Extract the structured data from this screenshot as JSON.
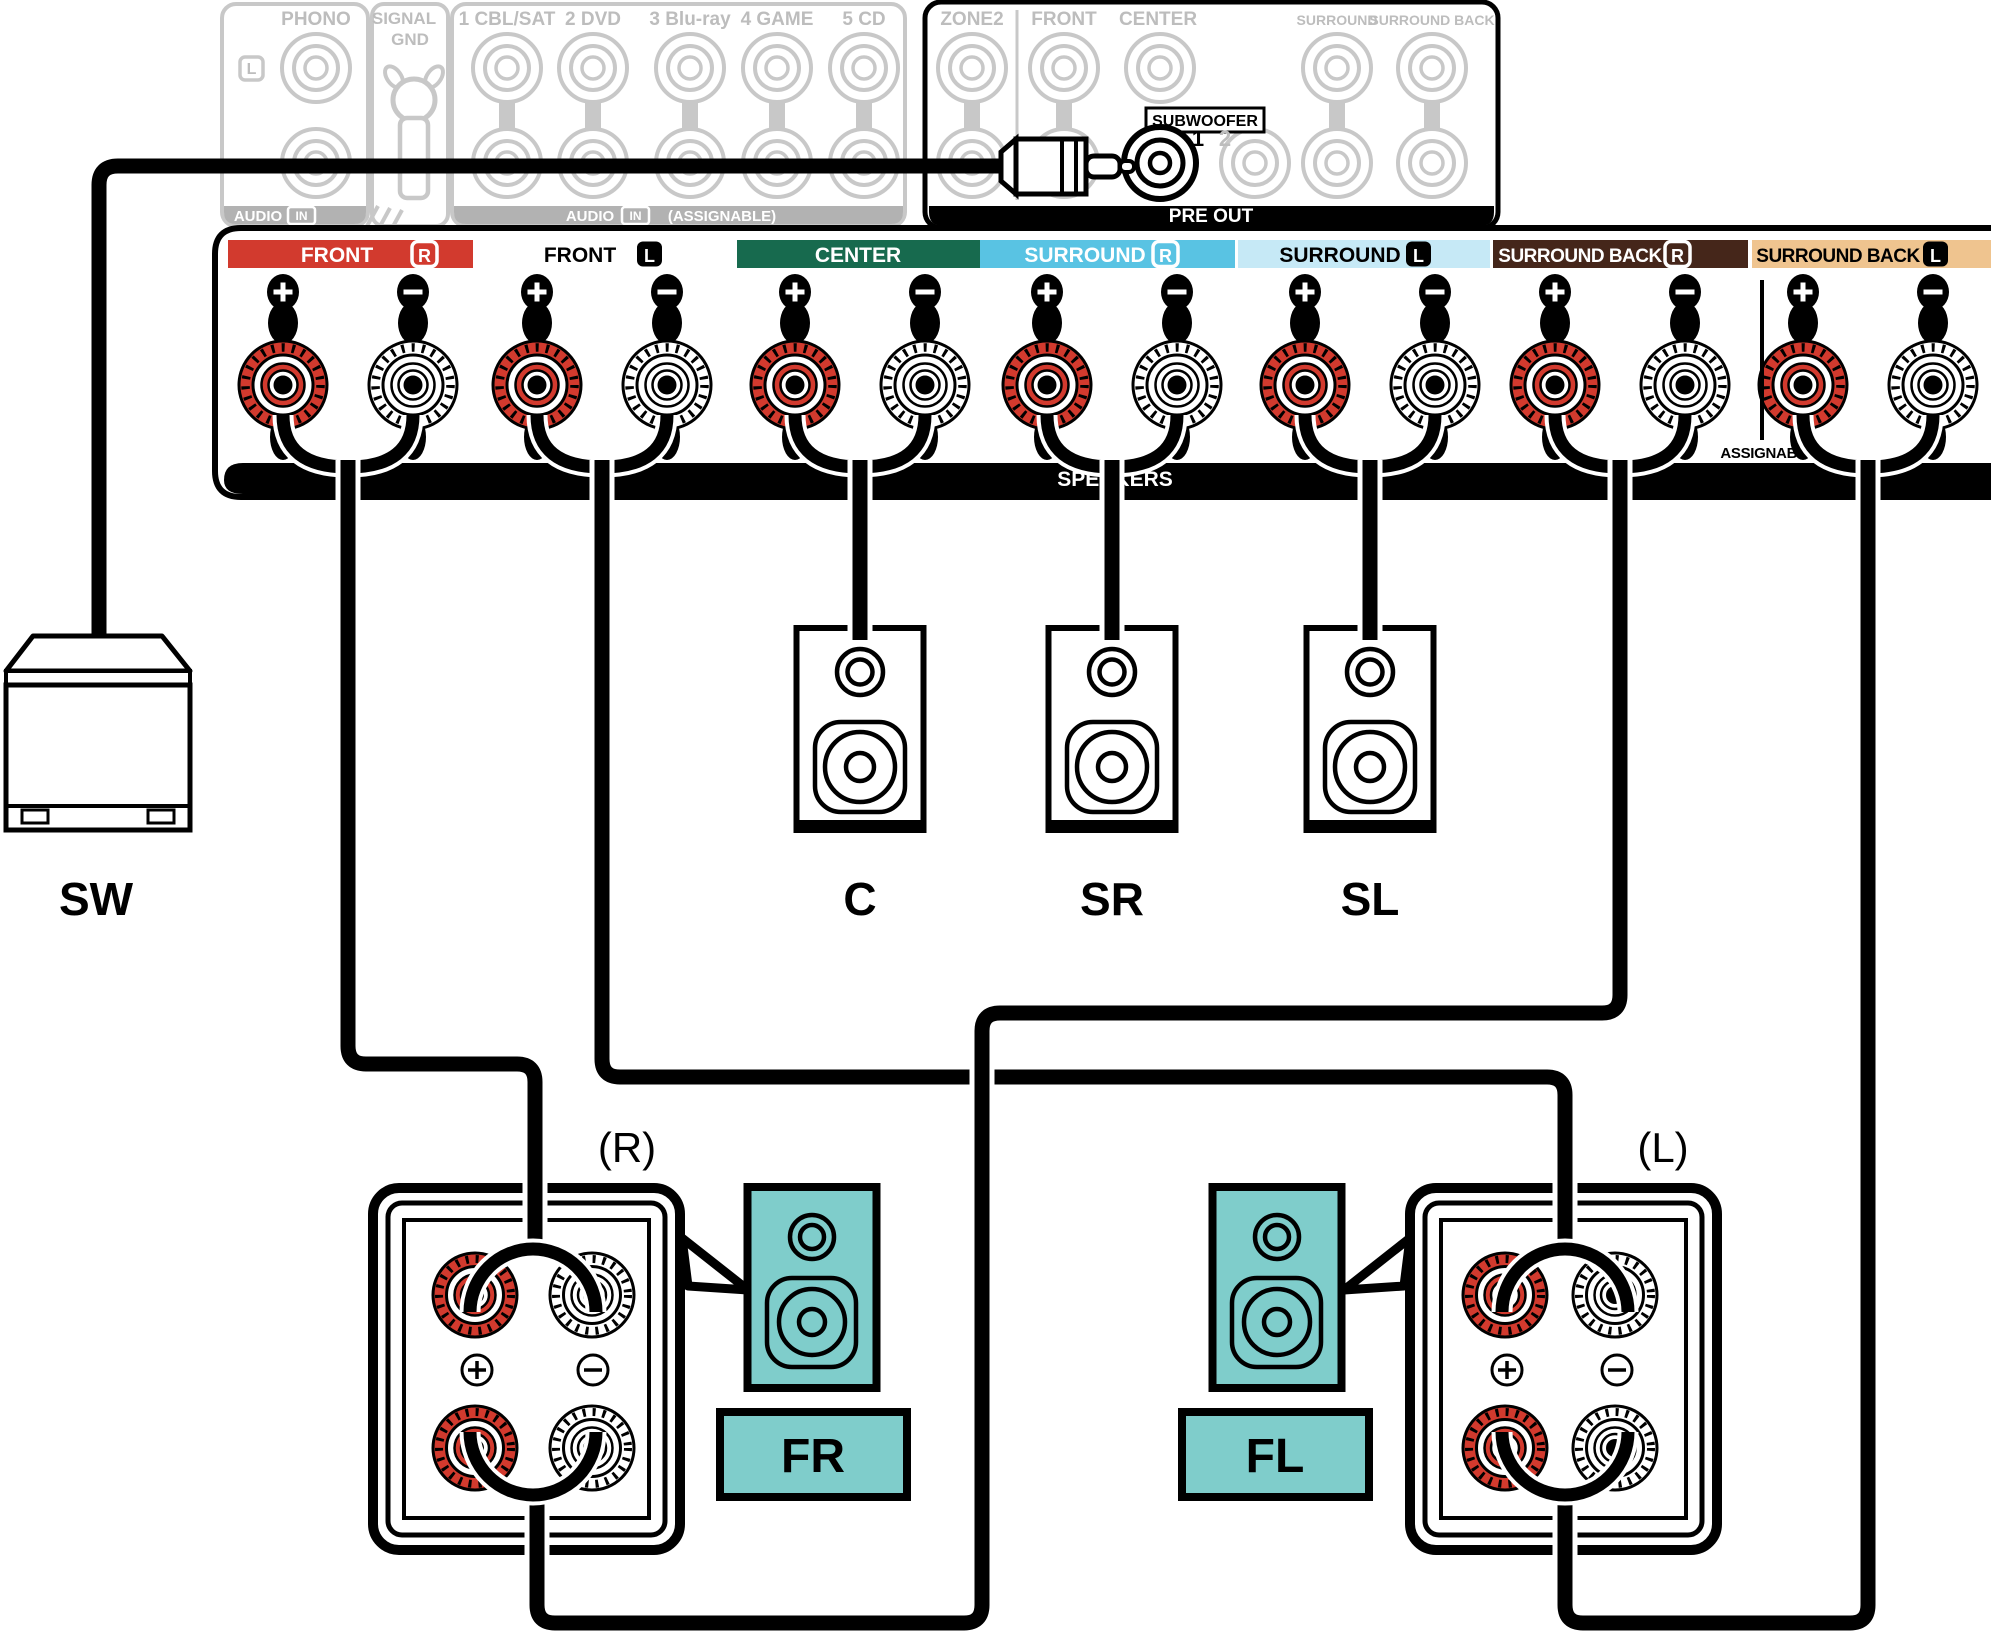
{
  "rear_panel": {
    "phono": {
      "label": "PHONO",
      "channel_badge": "L",
      "bar_audio": "AUDIO",
      "bar_in": "IN"
    },
    "signal_gnd": {
      "line1": "SIGNAL",
      "line2": "GND"
    },
    "inputs": {
      "columns": [
        "1 CBL/SAT",
        "2 DVD",
        "3 Blu-ray",
        "4 GAME",
        "5 CD"
      ],
      "bar_audio": "AUDIO",
      "bar_in": "IN",
      "bar_assignable": "(ASSIGNABLE)"
    },
    "pre_out": {
      "zone2": "ZONE2",
      "front": "FRONT",
      "center": "CENTER",
      "subwoofer": "SUBWOOFER",
      "sub1": "1",
      "sub2": "2",
      "surround": "SURROUND",
      "surround_back": "SURROUND BACK",
      "bar": "PRE OUT"
    }
  },
  "speaker_panel": {
    "bar": "SPEAKERS",
    "assignable": "ASSIGNABLE",
    "terminals": [
      {
        "label": "FRONT",
        "badge": "R",
        "color": "#D23A2E"
      },
      {
        "label": "FRONT",
        "badge": "L",
        "color": "none"
      },
      {
        "label": "CENTER",
        "badge": "",
        "color": "#176A4E"
      },
      {
        "label": "SURROUND",
        "badge": "R",
        "color": "#59C3E3"
      },
      {
        "label": "SURROUND",
        "badge": "L",
        "color": "#C6E9F6"
      },
      {
        "label": "SURROUND BACK",
        "badge": "R",
        "color": "#45261A"
      },
      {
        "label": "SURROUND BACK",
        "badge": "L",
        "color": "#EFC48F"
      }
    ]
  },
  "speakers": {
    "center": "C",
    "surround_right": "SR",
    "surround_left": "SL",
    "subwoofer": "SW",
    "front_right": "FR",
    "front_left": "FL",
    "right_mark": "(R)",
    "left_mark": "(L)"
  },
  "colors": {
    "red": "#D23A2E",
    "green": "#176A4E",
    "blue": "#59C3E3",
    "pale_blue": "#C6E9F6",
    "brown": "#45261A",
    "tan": "#EFC48F",
    "teal": "#7FCDCB",
    "gray_line": "#C8C8C8",
    "gray_bar": "#B2B2B2",
    "gray_text": "#BDBDBD"
  }
}
